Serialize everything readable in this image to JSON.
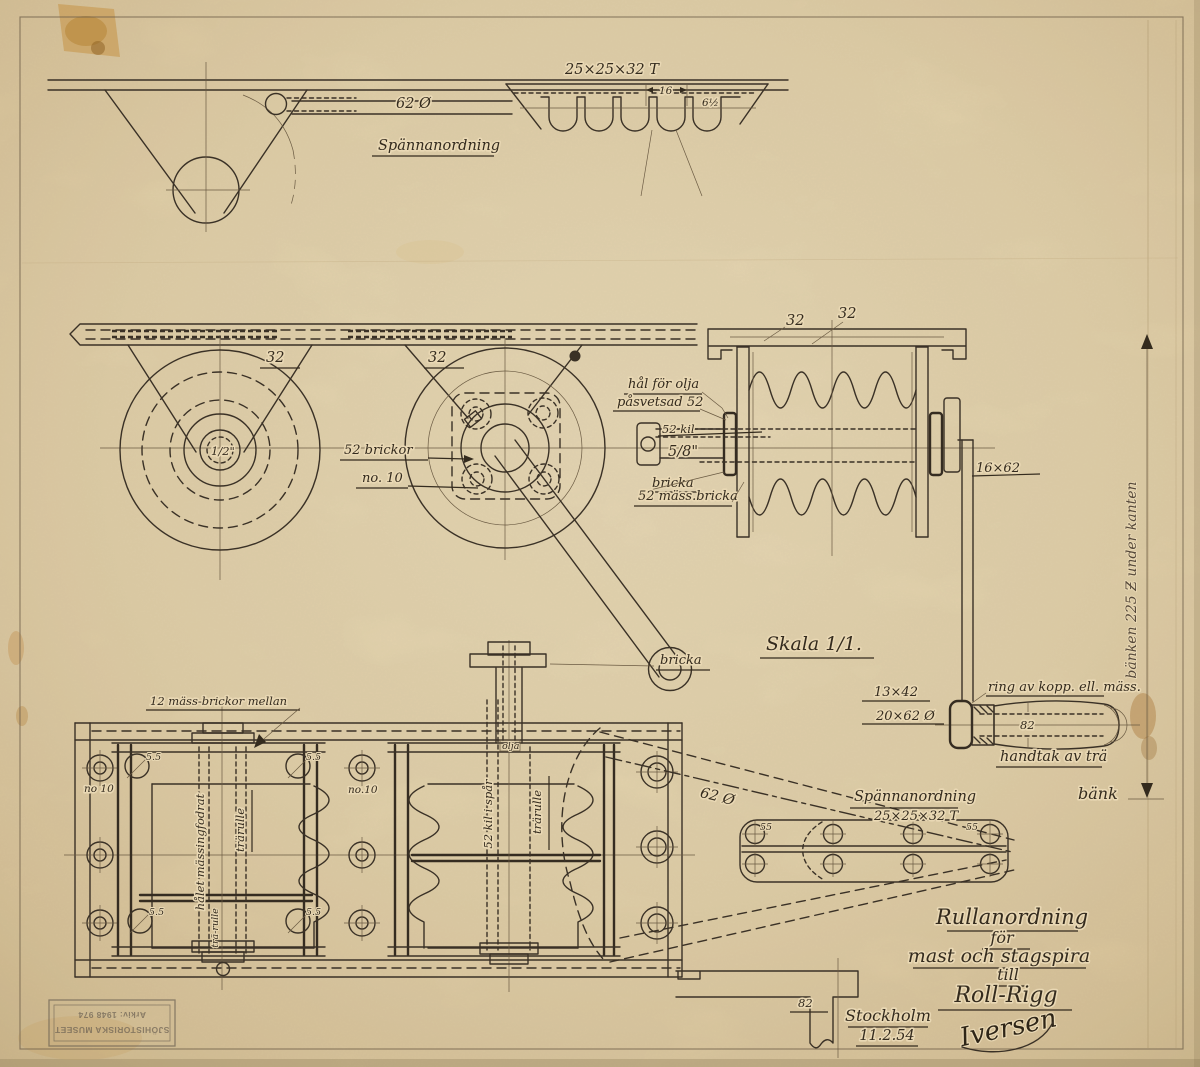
{
  "titleblock": {
    "l1": "Rullanordning",
    "l2": "för",
    "l3": "mast och stagspira",
    "l4": "till",
    "l5": "Roll-Rigg",
    "place": "Stockholm",
    "date": "11.2.54",
    "signature": "Iversen"
  },
  "stamp": {
    "l1": "SJÖHISTORISKA MUSEET",
    "l2": "Arkiv: 1948 974"
  },
  "top_view": {
    "title": "Spännanordning",
    "profile": "25×25×32 T",
    "rod": "62 Ø",
    "pitch": "16",
    "tip": "6½"
  },
  "side_view": {
    "dim32": "32",
    "bore": "1/2\"",
    "washers1": "52 brickor",
    "washers2": "no. 10",
    "oil1": "hål för olja",
    "oil2": "påsvetsad 52",
    "key": "52 kil",
    "pin": "5/8\"",
    "washer": "bricka",
    "brass": "52 mäss.bricka",
    "bracket": "16×62",
    "scale": "Skala 1/1."
  },
  "crank": {
    "cap": "13×42",
    "hub": "20×62 Ø",
    "ring": "ring av kopp. ell. mäss.",
    "len": "82",
    "wood": "handtak av trä",
    "bench": "bänk",
    "bench_note": "bänken 225 Ƶ under kanten"
  },
  "plan_view": {
    "spacers": "12 mäss-brickor mellan",
    "hole_l": "no 10",
    "hole_m": "no.10",
    "bolt": "5.5",
    "roller": "trärulle",
    "roller_sm": "trä-rulle",
    "bore_note": "hålet mässingfodrat",
    "key_note": "52 kil i spår",
    "oil": "olja",
    "washer": "bricka",
    "rod": "62 Ø",
    "tensioner": "Spännanordning",
    "profile": "25×25×32 T",
    "plate_hole": "55",
    "bracket": "82"
  }
}
